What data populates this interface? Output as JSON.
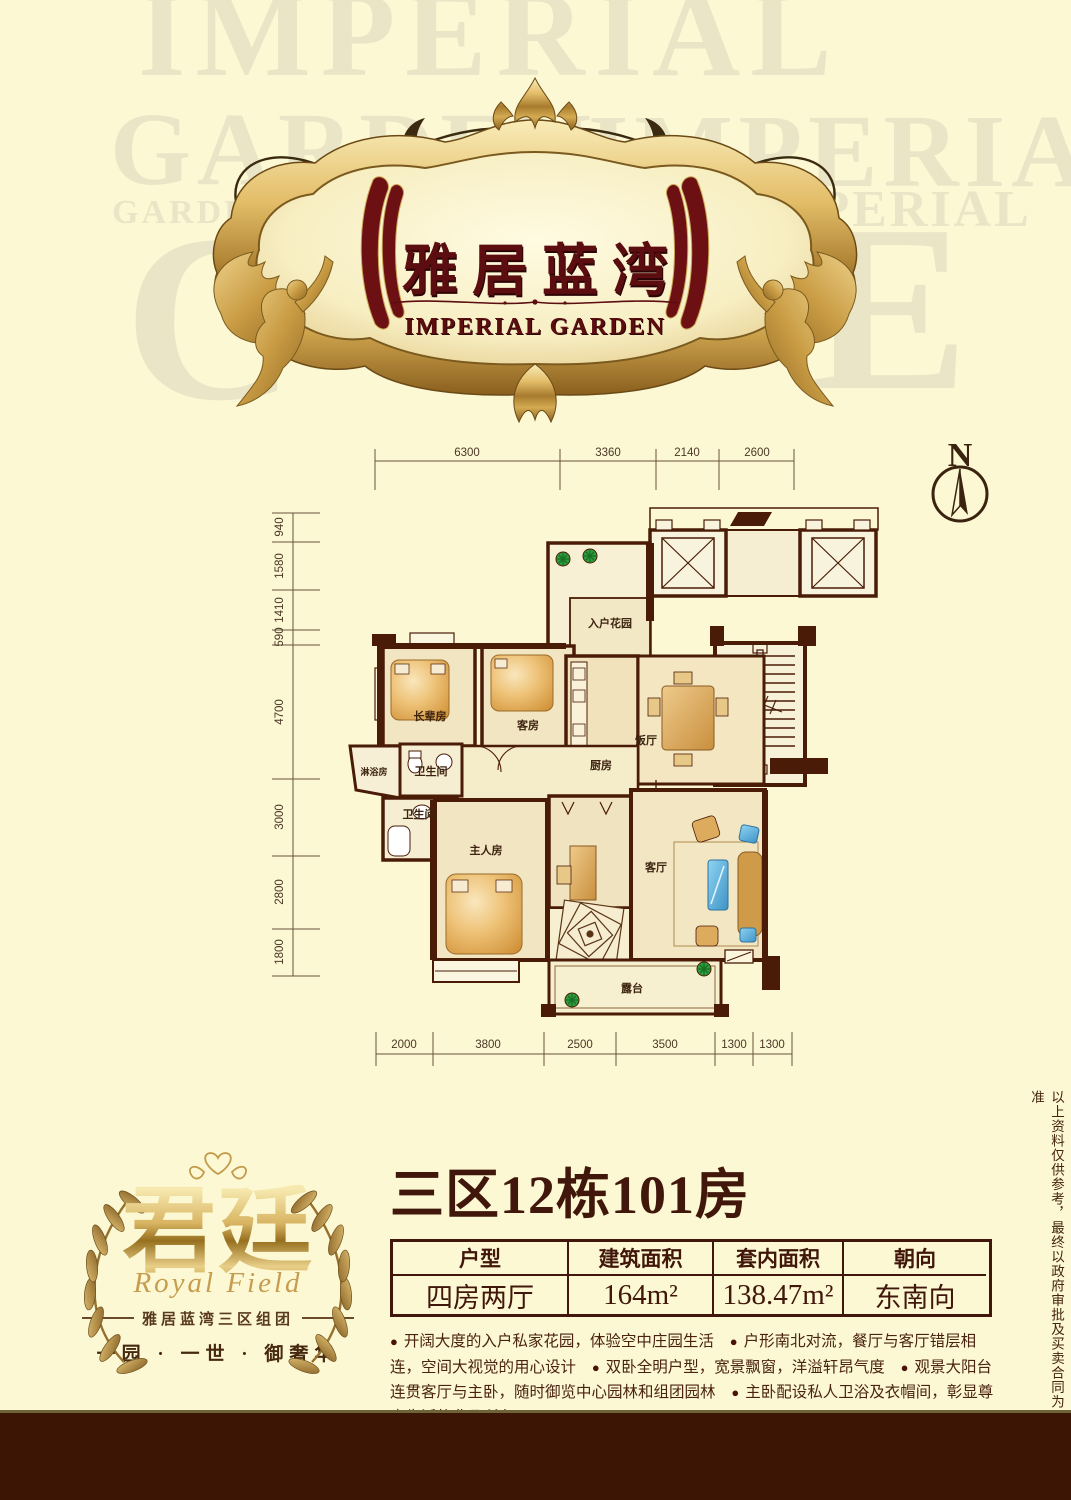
{
  "brand": {
    "logo_cn": "雅居蓝湾",
    "logo_en": "IMPERIAL GARDEN",
    "watermark": [
      "IMPERIAL",
      "GARDEN",
      "IMPERIAL",
      "GARDEN",
      "IMPERIAL",
      "C",
      "E"
    ]
  },
  "compass": {
    "label": "N"
  },
  "floorplan": {
    "dims_top": [
      "6300",
      "3360",
      "2140",
      "2600"
    ],
    "dims_left": [
      "940",
      "1580",
      "1410",
      "590",
      "4700",
      "3000",
      "2800",
      "1800"
    ],
    "dims_bottom": [
      "2000",
      "3800",
      "2500",
      "3500",
      "1300",
      "1300"
    ],
    "rooms": {
      "entry_garden": "入户花园",
      "elder_room": "长辈房",
      "guest_room": "客房",
      "kitchen": "厨房",
      "dining": "饭厅",
      "shower": "淋浴房",
      "bath1": "卫生间",
      "bath2": "卫生间",
      "master": "主人房",
      "living": "客厅",
      "terrace": "露台"
    }
  },
  "unit": {
    "title": "三区12栋101房",
    "bullet": "●",
    "table": {
      "headers": [
        "户型",
        "建筑面积",
        "套内面积",
        "朝向"
      ],
      "values": [
        "四房两厅",
        "164m²",
        "138.47m²",
        "东南向"
      ]
    },
    "features": [
      "开阔大度的入户私家花园，体验空中庄园生活",
      "户形南北对流，餐厅与客厅错层相连，空间大视觉的用心设计",
      "双卧全明户型，宽景飘窗，洋溢轩昂气度",
      "观景大阳台连贯客厅与主卧，随时御览中心园林和组团园林",
      "主卧配设私人卫浴及衣帽间，彰显尊贵生活的非凡所在"
    ]
  },
  "sublogo": {
    "name_cn": "君廷",
    "name_en": "Royal Field",
    "group": "雅居蓝湾三区组团",
    "slogan": "一园 · 一世 · 御奢华"
  },
  "disclaimer": "以上资料仅供参考，最终以政府审批及买卖合同为准",
  "colors": {
    "background": "#fcf8d3",
    "maroon_text": "#5c0d10",
    "wall_brown": "#4a1c07",
    "gold": "#c9a352",
    "footer_bar": "#3d1504",
    "sofa_blue": "#4fa8d8",
    "plant_green": "#2e9d3e"
  }
}
